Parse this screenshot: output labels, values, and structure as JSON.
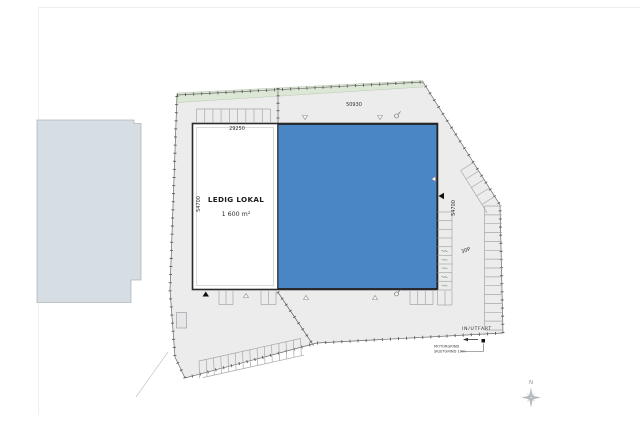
{
  "drawing": {
    "building": {
      "vacant_label": "LEDIG LOKAL",
      "vacant_area": "1 600 m²"
    },
    "dimensions": {
      "top": "50930",
      "vacant_width": "29250",
      "left_depth": "54700",
      "right_depth": "54700"
    },
    "site": {
      "parking_label": "30P",
      "entrance_label": "IN/UTFART",
      "gate_note_line1": "MOTORGRIND",
      "gate_note_line2": "SKJUTGRIND 10m"
    },
    "compass": {
      "north_label": "N"
    },
    "colors": {
      "occupied_fill": "#4a86c6",
      "vacant_fill": "#ffffff",
      "site_fill": "#ececec",
      "vegetation_fill": "#dce7d5",
      "neighbor_fill": "#d6dee3"
    }
  }
}
